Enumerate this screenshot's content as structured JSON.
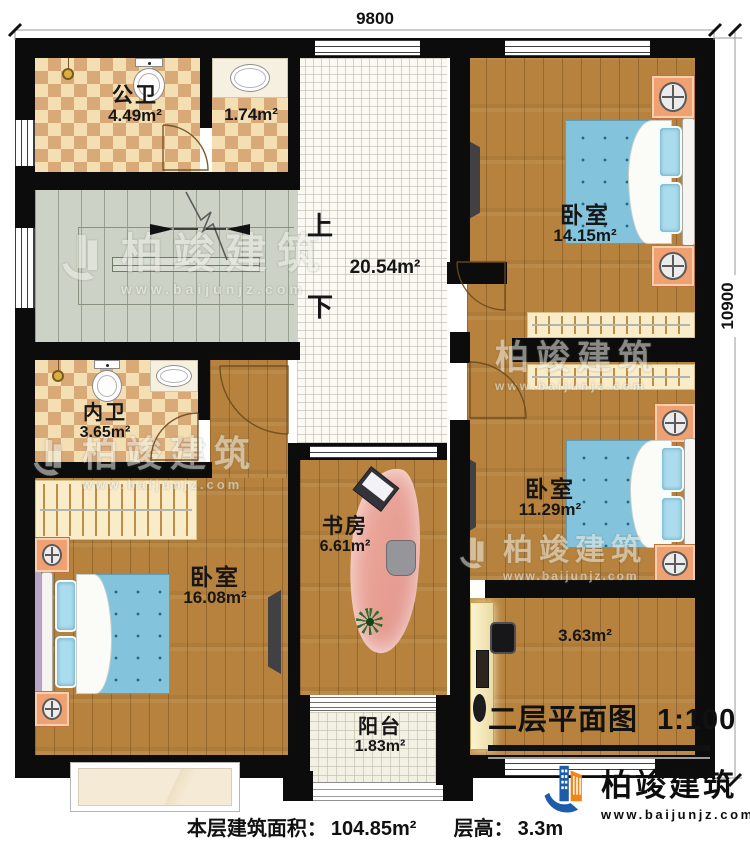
{
  "dimensions": {
    "width": "9800",
    "height": "10900"
  },
  "rooms": {
    "public_bath": {
      "name": "公卫",
      "area": "4.49m²"
    },
    "small_bath": {
      "area": "1.74m²"
    },
    "bedroom_tr": {
      "name": "卧室",
      "area": "14.15m²"
    },
    "hall": {
      "up": "上",
      "down": "下",
      "area": "20.54m²"
    },
    "inner_bath": {
      "name": "内卫",
      "area": "3.65m²"
    },
    "bedroom_br": {
      "name": "卧室",
      "area": "11.29m²"
    },
    "study": {
      "name": "书房",
      "area": "6.61m²"
    },
    "bedroom_bl": {
      "name": "卧室",
      "area": "16.08m²"
    },
    "corridor": {
      "area": "3.63m²"
    },
    "balcony": {
      "name": "阳台",
      "area": "1.83m²"
    }
  },
  "title_block": {
    "title": "二层平面图",
    "scale": "1:100"
  },
  "footer": {
    "area_label": "本层建筑面积：",
    "area_value": "104.85m²",
    "height_label": "层高：",
    "height_value": "3.3m"
  },
  "logo": {
    "company": "柏竣建筑",
    "website": "www.baijunjz.com"
  },
  "watermark": {
    "text": "柏竣建筑",
    "website": "www.baijunjz.com"
  },
  "colors": {
    "wall": "#0c0c0c",
    "wood_floor": "#b6823d",
    "tile_light": "#f4dfb2",
    "tile_dark": "#d9a978",
    "bed_blue": "#83c4dc",
    "logo_blue": "#1c5ca8",
    "logo_orange": "#f08519"
  }
}
